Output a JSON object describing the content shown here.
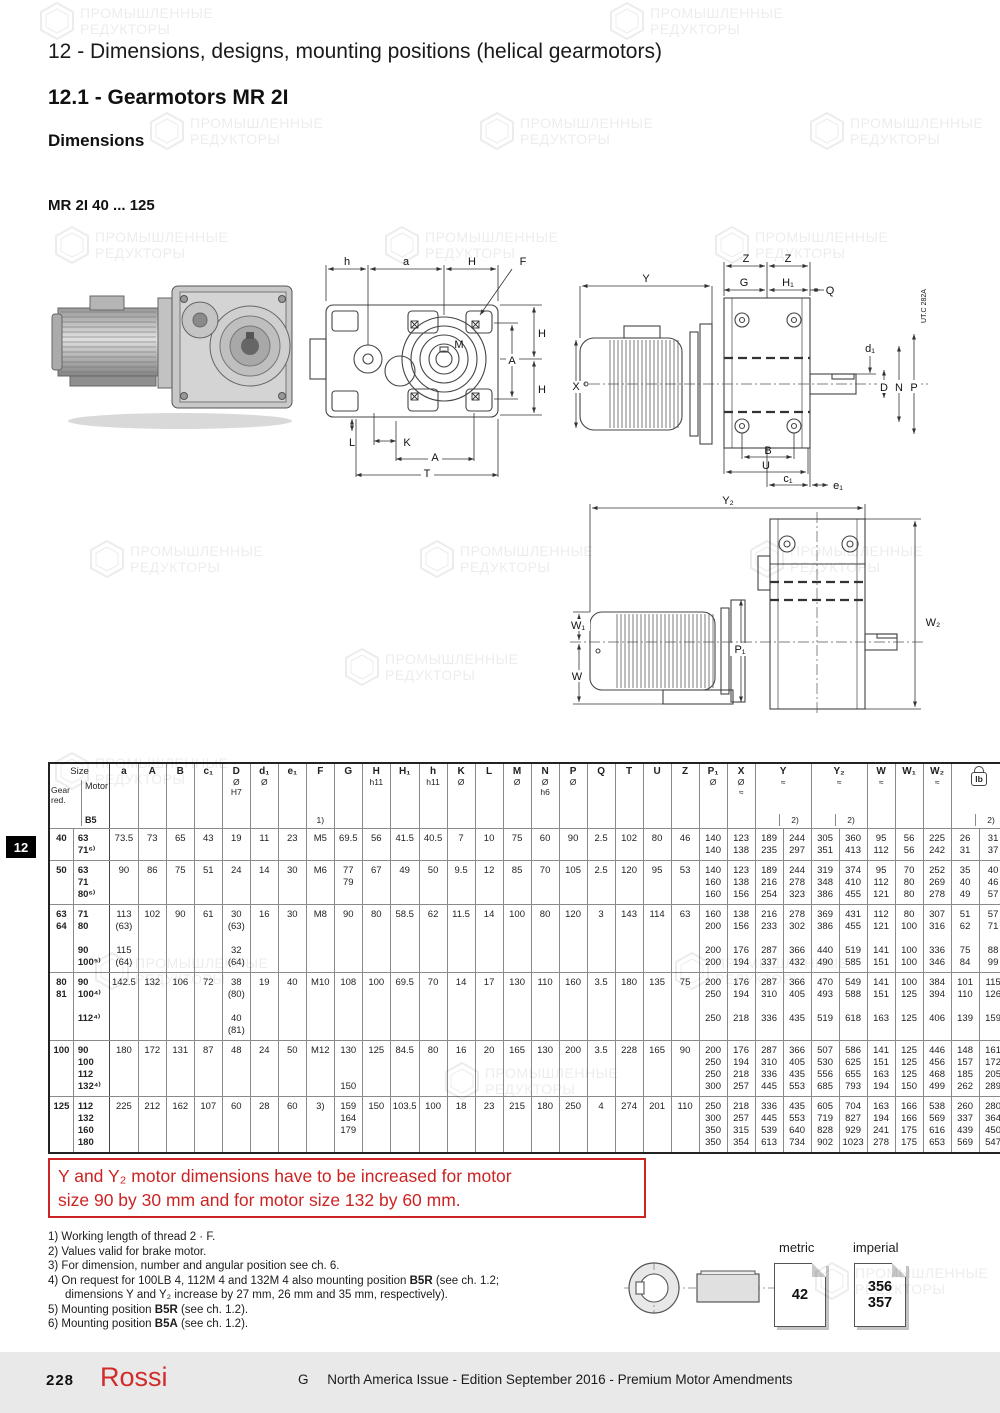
{
  "watermark": {
    "line1": "ПРОМЫШЛЕННЫЕ",
    "line2": "РЕДУКТОРЫ"
  },
  "header": {
    "chapter_title": "12 - Dimensions, designs, mounting positions (helical gearmotors)",
    "section_title": "12.1 - Gearmotors MR 2I",
    "subsection": "Dimensions",
    "model_range": "MR 2I 40 ... 125"
  },
  "drawings": {
    "code": "UT.C 282A",
    "front_labels": {
      "h": "h",
      "a": "a",
      "H": "H",
      "F": "F",
      "A": "A",
      "M": "M",
      "L": "L",
      "K": "K",
      "T": "T"
    },
    "side_labels": {
      "Z": "Z",
      "Y": "Y",
      "G": "G",
      "H1": "H₁",
      "Q": "Q",
      "X": "X",
      "d1": "d₁",
      "D": "D",
      "N": "N",
      "P": "P",
      "B": "B",
      "U": "U",
      "c1": "c₁",
      "e1": "e₁"
    },
    "bottom_labels": {
      "Y2": "Y₂",
      "W1": "W₁",
      "W": "W",
      "P1": "P₁",
      "W2": "W₂"
    }
  },
  "table": {
    "size_header": {
      "title": "Size",
      "gear": "Gear\nred.",
      "motor": "Motor",
      "b5": "B5"
    },
    "columns": [
      {
        "id": "a",
        "l": "a"
      },
      {
        "id": "A",
        "l": "A"
      },
      {
        "id": "B",
        "l": "B"
      },
      {
        "id": "c1",
        "l": "c₁"
      },
      {
        "id": "D",
        "l": "D",
        "s": "Ø\nH7"
      },
      {
        "id": "d1",
        "l": "d₁",
        "s": "Ø"
      },
      {
        "id": "e1",
        "l": "e₁"
      },
      {
        "id": "F",
        "l": "F",
        "n": "1)"
      },
      {
        "id": "G",
        "l": "G"
      },
      {
        "id": "H",
        "l": "H",
        "s": "h11"
      },
      {
        "id": "H1",
        "l": "H₁"
      },
      {
        "id": "h",
        "l": "h",
        "s": "h11"
      },
      {
        "id": "K",
        "l": "K",
        "s": "Ø"
      },
      {
        "id": "L",
        "l": "L"
      },
      {
        "id": "M",
        "l": "M",
        "s": "Ø"
      },
      {
        "id": "N",
        "l": "N",
        "s": "Ø\nh6"
      },
      {
        "id": "P",
        "l": "P",
        "s": "Ø"
      },
      {
        "id": "Q",
        "l": "Q"
      },
      {
        "id": "T",
        "l": "T"
      },
      {
        "id": "U",
        "l": "U"
      },
      {
        "id": "Z",
        "l": "Z"
      },
      {
        "id": "P1",
        "l": "P₁",
        "s": "Ø"
      },
      {
        "id": "X",
        "l": "X",
        "s": "Ø\n≈"
      },
      {
        "id": "Y",
        "l": "Y",
        "s": "≈",
        "pair": true,
        "n2": "2)"
      },
      {
        "id": "Y2",
        "l": "Y₂",
        "s": "≈",
        "pair": true,
        "n2": "2)"
      },
      {
        "id": "W",
        "l": "W",
        "s": "≈"
      },
      {
        "id": "W1",
        "l": "W₁"
      },
      {
        "id": "W2",
        "l": "W₂",
        "s": "≈"
      },
      {
        "id": "lb",
        "l": "lb",
        "icon": true,
        "pair": true,
        "n2": "2)"
      }
    ],
    "rows": [
      {
        "gear": "40",
        "motor": "63\n71⁶⁾",
        "cells": [
          "73.5",
          "73",
          "65",
          "43",
          "19",
          "11",
          "23",
          "M5",
          "69.5",
          "56",
          "41.5",
          "40.5",
          "7",
          "10",
          "75",
          "60",
          "90",
          "2.5",
          "102",
          "80",
          "46",
          "140\n140",
          "123\n138",
          "189\n235",
          "244\n297",
          "305\n351",
          "360\n413",
          "95\n112",
          "56\n56",
          "225\n242",
          "26\n31",
          "31\n37"
        ]
      },
      {
        "gear": "50",
        "motor": "63\n71\n80⁶⁾",
        "cells": [
          "90",
          "86",
          "75",
          "51",
          "24",
          "14",
          "30",
          "M6",
          "77\n79",
          "67",
          "49",
          "50",
          "9.5",
          "12",
          "85",
          "70",
          "105",
          "2.5",
          "120",
          "95",
          "53",
          "140\n160\n160",
          "123\n138\n156",
          "189\n216\n254",
          "244\n278\n323",
          "319\n348\n386",
          "374\n410\n455",
          "95\n112\n121",
          "70\n80\n80",
          "252\n269\n278",
          "35\n40\n49",
          "40\n46\n57"
        ]
      },
      {
        "gear": "63\n64",
        "motor": "71\n80\n\n90\n100⁵⁾",
        "cells": [
          "113\n(63)\n\n115\n(64)",
          "102",
          "90",
          "61",
          "30\n(63)\n\n32\n(64)",
          "16",
          "30",
          "M8",
          "90",
          "80",
          "58.5",
          "62",
          "11.5",
          "14",
          "100",
          "80",
          "120",
          "3",
          "143",
          "114",
          "63",
          "160\n200\n\n200\n200",
          "138\n156\n\n176\n194",
          "216\n233\n\n287\n337",
          "278\n302\n\n366\n432",
          "369\n386\n\n440\n490",
          "431\n455\n\n519\n585",
          "112\n121\n\n141\n151",
          "80\n100\n\n100\n100",
          "307\n316\n\n336\n346",
          "51\n62\n\n75\n84",
          "57\n71\n\n88\n99"
        ]
      },
      {
        "gear": "80\n81",
        "motor": "90\n100⁴⁾\n\n112⁴⁾",
        "cells": [
          "142.5",
          "132",
          "106",
          "72",
          "38\n(80)\n\n40\n(81)",
          "19",
          "40",
          "M10",
          "108",
          "100",
          "69.5",
          "70",
          "14",
          "17",
          "130",
          "110",
          "160",
          "3.5",
          "180",
          "135",
          "75",
          "200\n250\n\n250",
          "176\n194\n\n218",
          "287\n310\n\n336",
          "366\n405\n\n435",
          "470\n493\n\n519",
          "549\n588\n\n618",
          "141\n151\n\n163",
          "100\n125\n\n125",
          "384\n394\n\n406",
          "101\n110\n\n139",
          "115\n126\n\n159"
        ]
      },
      {
        "gear": "100",
        "motor": "90\n100\n112\n132⁴⁾",
        "cells": [
          "180",
          "172",
          "131",
          "87",
          "48",
          "24",
          "50",
          "M12",
          "130\n\n\n150",
          "125",
          "84.5",
          "80",
          "16",
          "20",
          "165",
          "130",
          "200",
          "3.5",
          "228",
          "165",
          "90",
          "200\n250\n250\n300",
          "176\n194\n218\n257",
          "287\n310\n336\n445",
          "366\n405\n435\n553",
          "507\n530\n556\n685",
          "586\n625\n655\n793",
          "141\n151\n163\n194",
          "125\n125\n125\n150",
          "446\n456\n468\n499",
          "148\n157\n185\n262",
          "161\n172\n205\n289"
        ]
      },
      {
        "gear": "125",
        "motor": "112\n132\n160\n180",
        "cells": [
          "225",
          "212",
          "162",
          "107",
          "60",
          "28",
          "60",
          "3)",
          "159\n164\n179",
          "150",
          "103.5",
          "100",
          "18",
          "23",
          "215",
          "180",
          "250",
          "4",
          "274",
          "201",
          "110",
          "250\n300\n350\n350",
          "218\n257\n315\n354",
          "336\n445\n539\n613",
          "435\n553\n640\n734",
          "605\n719\n828\n902",
          "704\n827\n929\n1023",
          "163\n194\n241\n278",
          "166\n166\n175\n175",
          "538\n569\n616\n653",
          "260\n337\n439\n569",
          "280\n364\n450\n547"
        ]
      }
    ]
  },
  "note_box": {
    "text": "Y and  Y₂ motor dimensions have to be increased for motor\nsize 90 by 30 mm and for motor size 132 by 60 mm."
  },
  "footnotes": [
    {
      "num": "1)",
      "parts": [
        {
          "t": "Working length of thread 2 · F.",
          "b": false
        }
      ]
    },
    {
      "num": "2)",
      "parts": [
        {
          "t": "Values valid for brake motor.",
          "b": false
        }
      ]
    },
    {
      "num": "3)",
      "parts": [
        {
          "t": "For dimension, number and angular position see ch. 6.",
          "b": false
        }
      ]
    },
    {
      "num": "4)",
      "parts": [
        {
          "t": "On request for 100LB 4, 112M 4 and 132M 4 also mounting position ",
          "b": false
        },
        {
          "t": "B5R",
          "b": true
        },
        {
          "t": " (see ch. 1.2;\ndimensions Y and Y₂ increase by 27 mm, 26 mm and 35 mm, respectively).",
          "b": false
        }
      ]
    },
    {
      "num": "5)",
      "parts": [
        {
          "t": "Mounting position ",
          "b": false
        },
        {
          "t": "B5R",
          "b": true
        },
        {
          "t": " (see ch. 1.2).",
          "b": false
        }
      ]
    },
    {
      "num": "6)",
      "parts": [
        {
          "t": "Mounting position ",
          "b": false
        },
        {
          "t": "B5A",
          "b": true
        },
        {
          "t": " (see ch. 1.2).",
          "b": false
        }
      ]
    }
  ],
  "page_refs": {
    "metric_label": "metric",
    "imperial_label": "imperial",
    "metric_page": "42",
    "imperial_pages": "356\n357"
  },
  "side_tab": {
    "label": "12"
  },
  "footer": {
    "page_number": "228",
    "brand": "Rossi",
    "edition": "G     North America Issue - Edition September 2016 - Premium Motor Amendments"
  }
}
